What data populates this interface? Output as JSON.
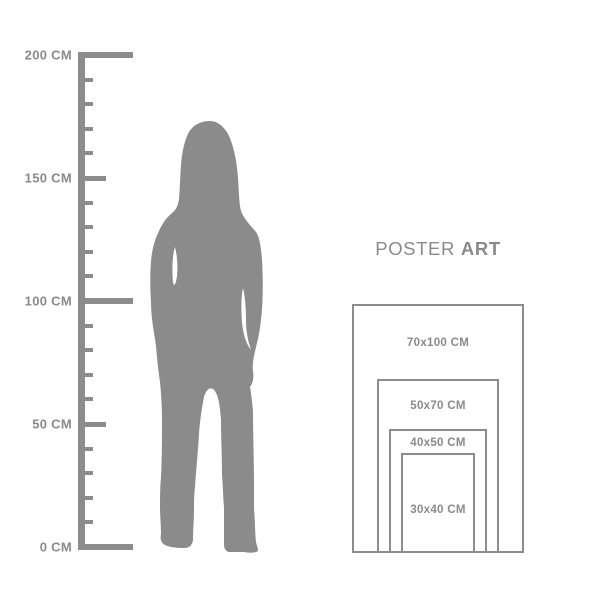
{
  "colors": {
    "background": "#ffffff",
    "figure": "#8b8b8b",
    "ruler": "#8c8c8c",
    "frame": "#8c8c8c",
    "text": "#8a8a8a"
  },
  "title": {
    "regular": "POSTER",
    "bold": "ART"
  },
  "ruler": {
    "unit": "CM",
    "min_cm": 0,
    "max_cm": 200,
    "minor_step_cm": 10,
    "medium_step_cm": 50,
    "major_step_cm": 100,
    "labels": [
      {
        "cm": 200,
        "text": "200 CM"
      },
      {
        "cm": 150,
        "text": "150 CM"
      },
      {
        "cm": 100,
        "text": "100 CM"
      },
      {
        "cm": 50,
        "text": "50 CM"
      },
      {
        "cm": 0,
        "text": "0 CM"
      }
    ]
  },
  "figure": {
    "icon": "woman-silhouette"
  },
  "size_guide": {
    "unit": "CM",
    "sizes": [
      {
        "label": "70x100 CM",
        "width_cm": 70,
        "height_cm": 100
      },
      {
        "label": "50x70 CM",
        "width_cm": 50,
        "height_cm": 70
      },
      {
        "label": "40x50 CM",
        "width_cm": 40,
        "height_cm": 50
      },
      {
        "label": "30x40 CM",
        "width_cm": 30,
        "height_cm": 40
      }
    ]
  }
}
